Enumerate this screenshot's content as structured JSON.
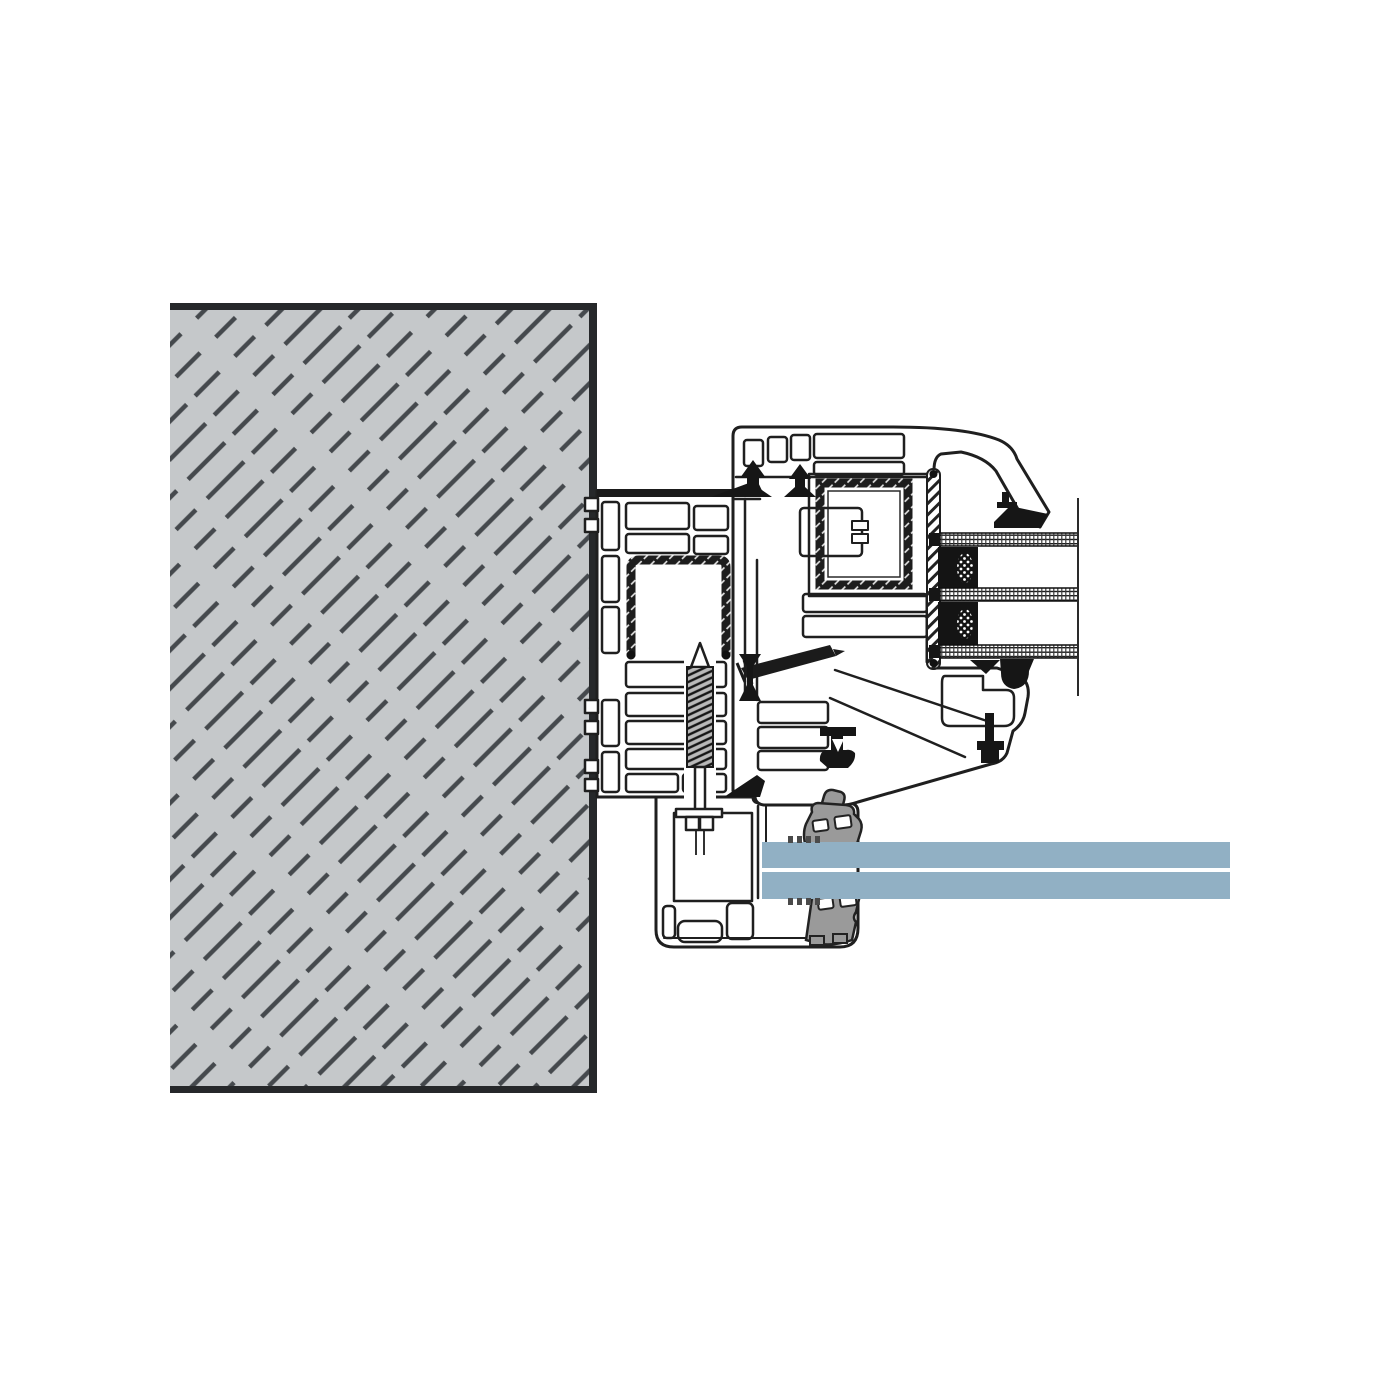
{
  "drawing": {
    "kind": "technical-section-detail",
    "subject": "Window jamb installation cross-section: masonry wall, PVC frame and sash with steel reinforcement, triple glazing unit, sill adapter with clamped glass panel",
    "canvas": {
      "width": 1400,
      "height": 1400
    },
    "text_labels": []
  },
  "colors": {
    "background": "#ffffff",
    "line": "#1f1f1f",
    "wall_fill": "#c5c8ca",
    "wall_border": "#26282a",
    "wall_hatch": "#45494d",
    "steel_dark": "#1d1d1d",
    "gasket": "#161616",
    "clamp": "#9a9a9a",
    "panel_glass": "#91b0c4",
    "thread_base": "#b9b9b9"
  },
  "components": {
    "wall": {
      "label": "masonry wall with diagonal dash hatching",
      "x": 170,
      "y": 303,
      "width": 426,
      "height": 790
    },
    "frame": {
      "label": "PVC window frame profile, multi-chamber, U-shaped steel reinforcement",
      "x": 584,
      "y": 489,
      "width": 161,
      "height": 308,
      "chamber_count": 13
    },
    "sash": {
      "label": "PVC sash profile, multi-chamber, square steel reinforcement",
      "x": 733,
      "y": 427,
      "width": 316,
      "height": 378
    },
    "glazing_unit": {
      "label": "triple insulated glazing unit (section), cut off by break line",
      "panes": [
        {
          "x": 940,
          "y": 533,
          "width": 138,
          "height": 13
        },
        {
          "x": 940,
          "y": 588,
          "width": 138,
          "height": 13
        },
        {
          "x": 940,
          "y": 645,
          "width": 138,
          "height": 13
        }
      ],
      "spacers": [
        {
          "x": 938,
          "y": 547,
          "width": 40,
          "height": 41
        },
        {
          "x": 938,
          "y": 602,
          "width": 40,
          "height": 43
        }
      ],
      "break_line": {
        "x": 1078,
        "y1": 498,
        "y2": 696
      }
    },
    "glazing_gasket_strip": {
      "label": "hatched glazing bridge strip",
      "x": 927,
      "y": 469,
      "width": 13,
      "height": 200
    },
    "sill_adapter": {
      "label": "aluminium sill / panel adapter profile",
      "x": 656,
      "y": 797,
      "width": 202,
      "height": 150
    },
    "clamps": [
      {
        "label": "upper glazing clamp",
        "x": 802,
        "y": 790,
        "width": 60,
        "height": 60
      },
      {
        "label": "lower glazing clamp",
        "x": 802,
        "y": 887,
        "width": 60,
        "height": 57
      }
    ],
    "glass_panel": {
      "label": "clamped infill glass panel (blue)",
      "panes": [
        {
          "x": 762,
          "y": 842,
          "width": 468,
          "height": 26
        },
        {
          "x": 762,
          "y": 872,
          "width": 468,
          "height": 27
        }
      ]
    },
    "screws": [
      {
        "label": "vertical fixing screw with washer and nut",
        "cx": 700,
        "tip_y": 643,
        "thread": [
          667,
          767
        ],
        "washer_y": 809
      },
      {
        "label": "diagonal installation screw",
        "from": [
          741,
          674
        ],
        "to": [
          840,
          650
        ]
      }
    ],
    "gaskets": {
      "label": "black EPDM seals / gaskets",
      "count": 9
    }
  }
}
